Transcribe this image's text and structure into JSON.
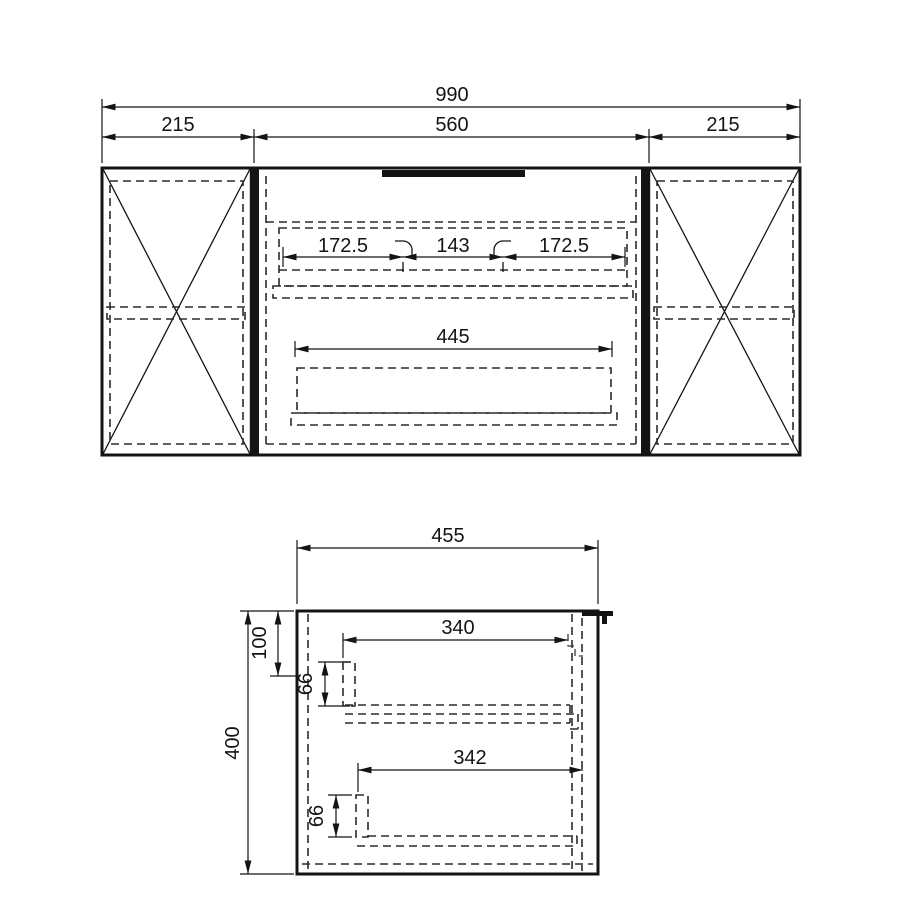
{
  "drawing": {
    "background": "#ffffff",
    "line_color": "#141414",
    "front_view": {
      "dim_overall_width": "990",
      "dim_left_door": "215",
      "dim_center_section": "560",
      "dim_right_door": "215",
      "dim_drawer_split_left": "172.5",
      "dim_drawer_handle": "143",
      "dim_drawer_split_right": "172.5",
      "dim_lower_drawer_width": "445"
    },
    "side_view": {
      "dim_depth": "455",
      "dim_height": "400",
      "dim_top_clearance": "100",
      "dim_upper_drawer_front": "66",
      "dim_upper_drawer_depth": "340",
      "dim_lower_drawer_depth": "342",
      "dim_lower_drawer_front": "66"
    }
  }
}
